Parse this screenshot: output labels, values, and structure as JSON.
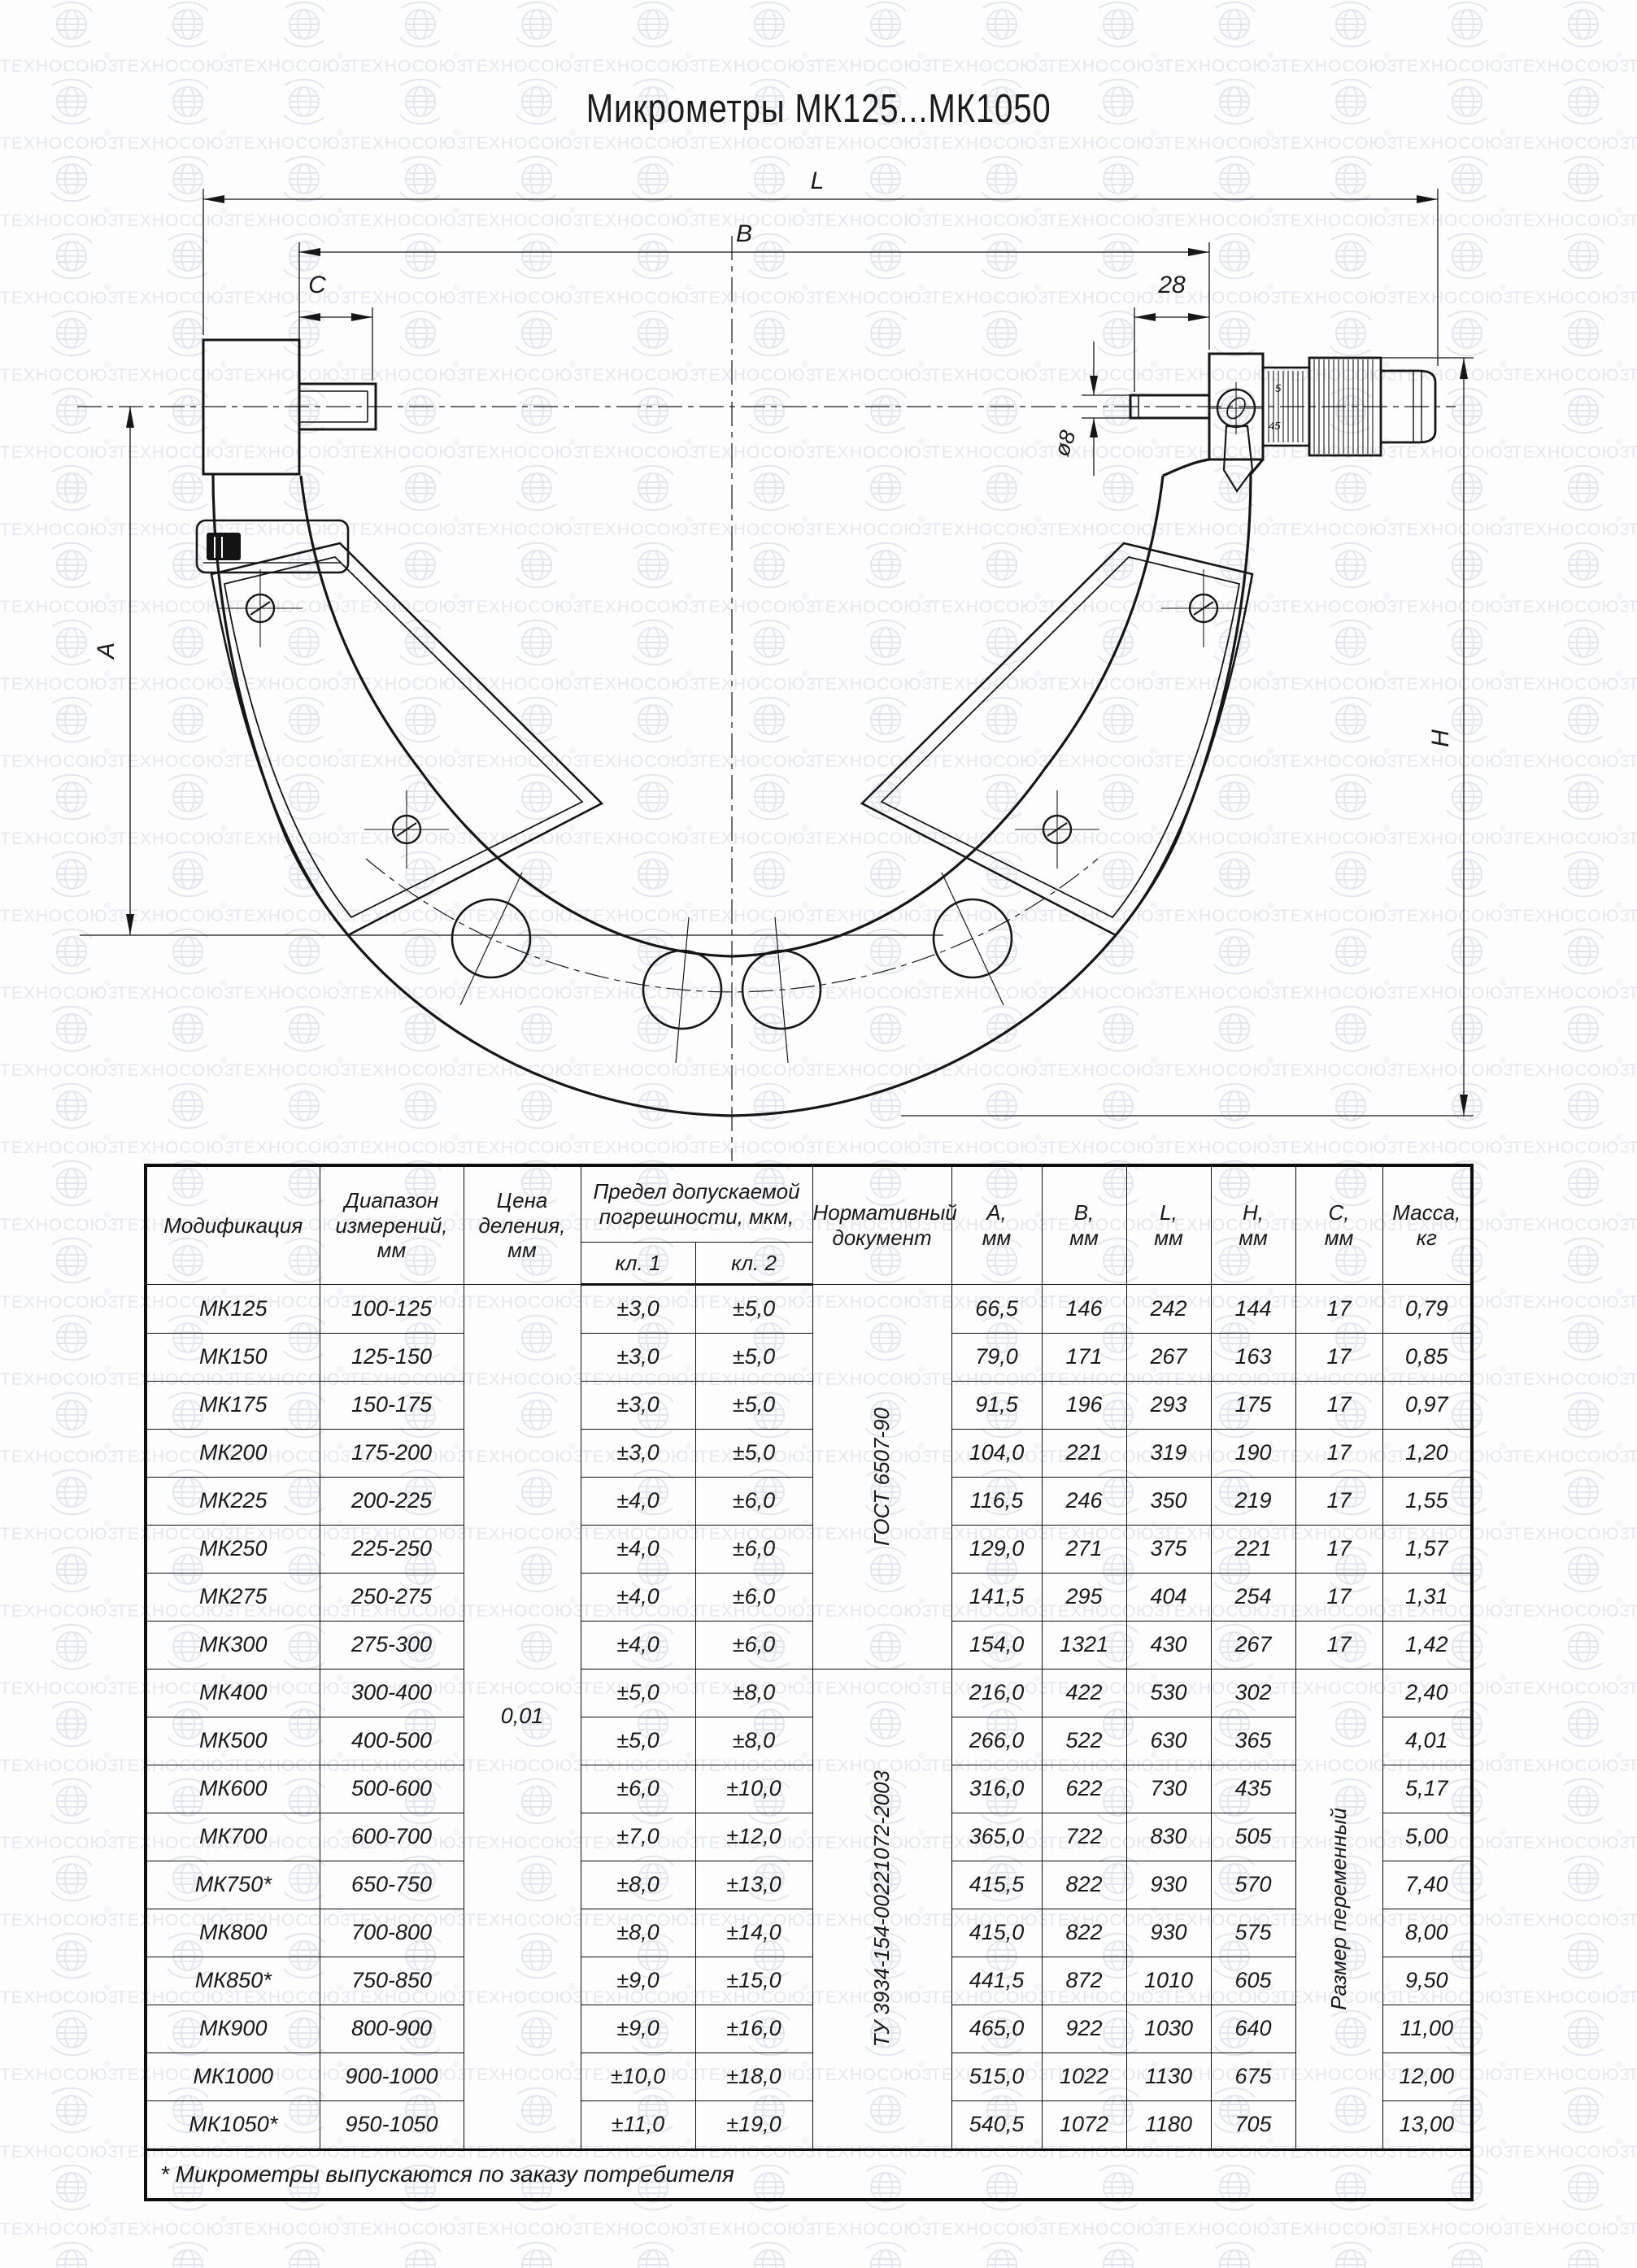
{
  "watermark": {
    "text": "ТЕХНОСОЮЗ",
    "reg": "®"
  },
  "title": "Микрометры МК125...МК1050",
  "drawing": {
    "labels": {
      "l": "L",
      "b": "B",
      "c": "C",
      "n28": "28",
      "d8": "ø8",
      "a": "A",
      "h": "H",
      "s5": "5",
      "s45": "45"
    }
  },
  "table": {
    "headers": {
      "modification": "Модификация",
      "range": "Диапазон\nизмерений,\nмм",
      "division": "Цена\nделения,\nмм",
      "error": "Предел допускаемой\nпогрешности, мкм,",
      "kl1": "кл. 1",
      "kl2": "кл. 2",
      "doc": "Нормативный\nдокумент",
      "a": "A,\nмм",
      "b": "B,\nмм",
      "l": "L,\nмм",
      "h": "H,\nмм",
      "c": "C,\nмм",
      "mass": "Масса,\nкг"
    },
    "shared": {
      "division": "0,01",
      "doc1": "ГОСТ 6507-90",
      "doc2": "ТУ 3934-154-00221072-2003",
      "c_note": "Размер переменный"
    },
    "rows": [
      {
        "model": "МК125",
        "range": "100-125",
        "kl1": "±3,0",
        "kl2": "±5,0",
        "a": "66,5",
        "b": "146",
        "l": "242",
        "h": "144",
        "c": "17",
        "mass": "0,79"
      },
      {
        "model": "МК150",
        "range": "125-150",
        "kl1": "±3,0",
        "kl2": "±5,0",
        "a": "79,0",
        "b": "171",
        "l": "267",
        "h": "163",
        "c": "17",
        "mass": "0,85"
      },
      {
        "model": "МК175",
        "range": "150-175",
        "kl1": "±3,0",
        "kl2": "±5,0",
        "a": "91,5",
        "b": "196",
        "l": "293",
        "h": "175",
        "c": "17",
        "mass": "0,97"
      },
      {
        "model": "МК200",
        "range": "175-200",
        "kl1": "±3,0",
        "kl2": "±5,0",
        "a": "104,0",
        "b": "221",
        "l": "319",
        "h": "190",
        "c": "17",
        "mass": "1,20"
      },
      {
        "model": "МК225",
        "range": "200-225",
        "kl1": "±4,0",
        "kl2": "±6,0",
        "a": "116,5",
        "b": "246",
        "l": "350",
        "h": "219",
        "c": "17",
        "mass": "1,55"
      },
      {
        "model": "МК250",
        "range": "225-250",
        "kl1": "±4,0",
        "kl2": "±6,0",
        "a": "129,0",
        "b": "271",
        "l": "375",
        "h": "221",
        "c": "17",
        "mass": "1,57"
      },
      {
        "model": "МК275",
        "range": "250-275",
        "kl1": "±4,0",
        "kl2": "±6,0",
        "a": "141,5",
        "b": "295",
        "l": "404",
        "h": "254",
        "c": "17",
        "mass": "1,31"
      },
      {
        "model": "МК300",
        "range": "275-300",
        "kl1": "±4,0",
        "kl2": "±6,0",
        "a": "154,0",
        "b": "1321",
        "l": "430",
        "h": "267",
        "c": "17",
        "mass": "1,42"
      },
      {
        "model": "МК400",
        "range": "300-400",
        "kl1": "±5,0",
        "kl2": "±8,0",
        "a": "216,0",
        "b": "422",
        "l": "530",
        "h": "302",
        "mass": "2,40"
      },
      {
        "model": "МК500",
        "range": "400-500",
        "kl1": "±5,0",
        "kl2": "±8,0",
        "a": "266,0",
        "b": "522",
        "l": "630",
        "h": "365",
        "mass": "4,01"
      },
      {
        "model": "МК600",
        "range": "500-600",
        "kl1": "±6,0",
        "kl2": "±10,0",
        "a": "316,0",
        "b": "622",
        "l": "730",
        "h": "435",
        "mass": "5,17"
      },
      {
        "model": "МК700",
        "range": "600-700",
        "kl1": "±7,0",
        "kl2": "±12,0",
        "a": "365,0",
        "b": "722",
        "l": "830",
        "h": "505",
        "mass": "5,00"
      },
      {
        "model": "МК750*",
        "range": "650-750",
        "kl1": "±8,0",
        "kl2": "±13,0",
        "a": "415,5",
        "b": "822",
        "l": "930",
        "h": "570",
        "mass": "7,40"
      },
      {
        "model": "МК800",
        "range": "700-800",
        "kl1": "±8,0",
        "kl2": "±14,0",
        "a": "415,0",
        "b": "822",
        "l": "930",
        "h": "575",
        "mass": "8,00"
      },
      {
        "model": "МК850*",
        "range": "750-850",
        "kl1": "±9,0",
        "kl2": "±15,0",
        "a": "441,5",
        "b": "872",
        "l": "1010",
        "h": "605",
        "mass": "9,50"
      },
      {
        "model": "МК900",
        "range": "800-900",
        "kl1": "±9,0",
        "kl2": "±16,0",
        "a": "465,0",
        "b": "922",
        "l": "1030",
        "h": "640",
        "mass": "11,00"
      },
      {
        "model": "МК1000",
        "range": "900-1000",
        "kl1": "±10,0",
        "kl2": "±18,0",
        "a": "515,0",
        "b": "1022",
        "l": "1130",
        "h": "675",
        "mass": "12,00"
      },
      {
        "model": "МК1050*",
        "range": "950-1050",
        "kl1": "±11,0",
        "kl2": "±19,0",
        "a": "540,5",
        "b": "1072",
        "l": "1180",
        "h": "705",
        "mass": "13,00"
      }
    ],
    "footnote": "* Микрометры выпускаются по заказу потребителя"
  }
}
